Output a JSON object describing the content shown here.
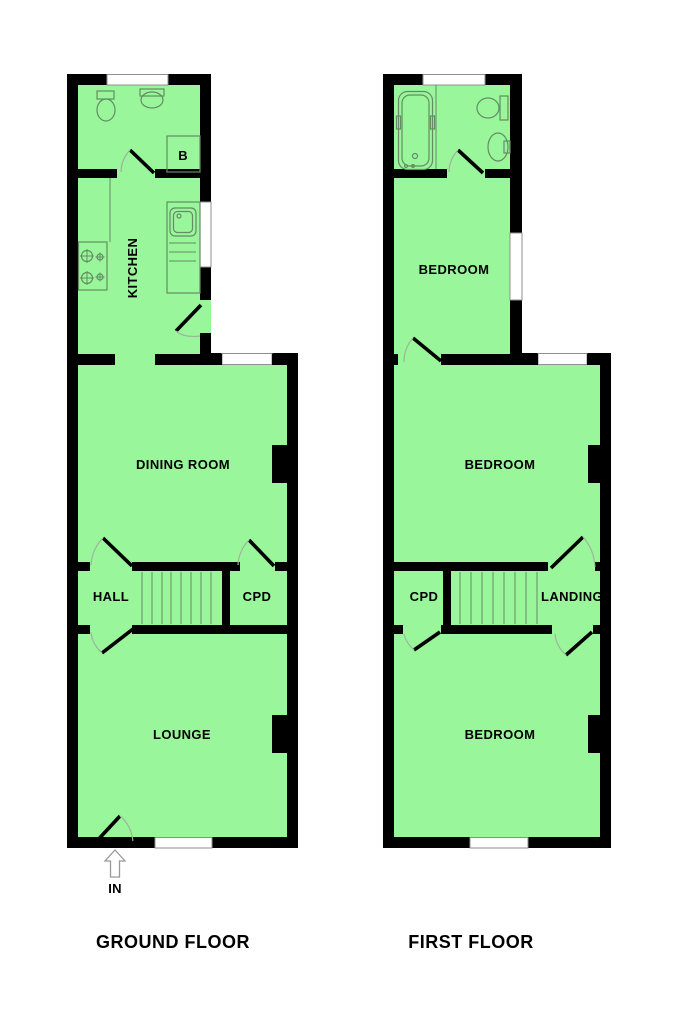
{
  "colors": {
    "floor_fill": "#9AF69A",
    "wall": "#000000",
    "fixture_line": "#648C64",
    "door_arc": "#9CB59C",
    "window_outline": "#8F8F8F"
  },
  "ground_floor": {
    "title": "GROUND FLOOR",
    "rooms": {
      "kitchen": "KITCHEN",
      "dining_room": "DINING ROOM",
      "hall": "HALL",
      "cupboard": "CPD",
      "lounge": "LOUNGE",
      "boiler": "B"
    },
    "entrance": "IN"
  },
  "first_floor": {
    "title": "FIRST FLOOR",
    "rooms": {
      "bedroom_top": "BEDROOM",
      "bedroom_middle": "BEDROOM",
      "bedroom_bottom": "BEDROOM",
      "cupboard": "CPD",
      "landing": "LANDING"
    }
  }
}
